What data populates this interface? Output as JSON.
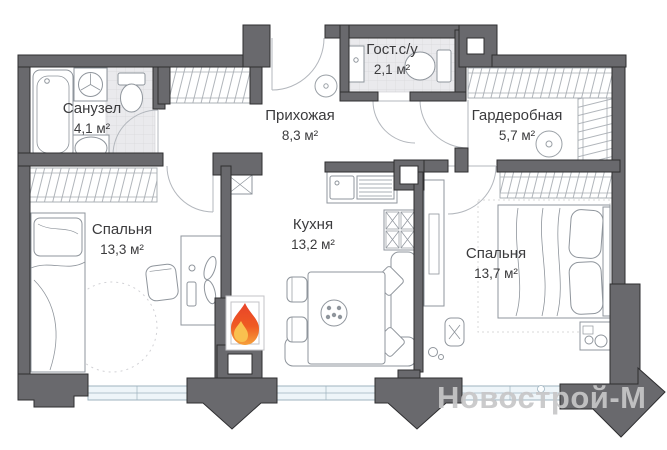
{
  "watermark": "Новострой-М",
  "rooms": [
    {
      "name": "Санузел",
      "area": "4,1 м²"
    },
    {
      "name": "Гост.с/у",
      "area": "2,1 м²"
    },
    {
      "name": "Прихожая",
      "area": "8,3 м²"
    },
    {
      "name": "Гардеробная",
      "area": "5,7 м²"
    },
    {
      "name": "Спальня",
      "area": "13,3 м²"
    },
    {
      "name": "Кухня",
      "area": "13,2 м²"
    },
    {
      "name": "Спальня",
      "area": "13,7 м²"
    }
  ],
  "icons": {
    "flame": "flame-icon",
    "ceiling_light": "ceiling-light-icon"
  },
  "colors": {
    "wall": "#69696d",
    "tile_floor": "#eaeaed",
    "window": "#eef5f9",
    "flame_top": "#e8432a",
    "flame_bottom": "#f6a13b",
    "watermark": "#c7c7c8",
    "text": "#3b3b3d"
  }
}
